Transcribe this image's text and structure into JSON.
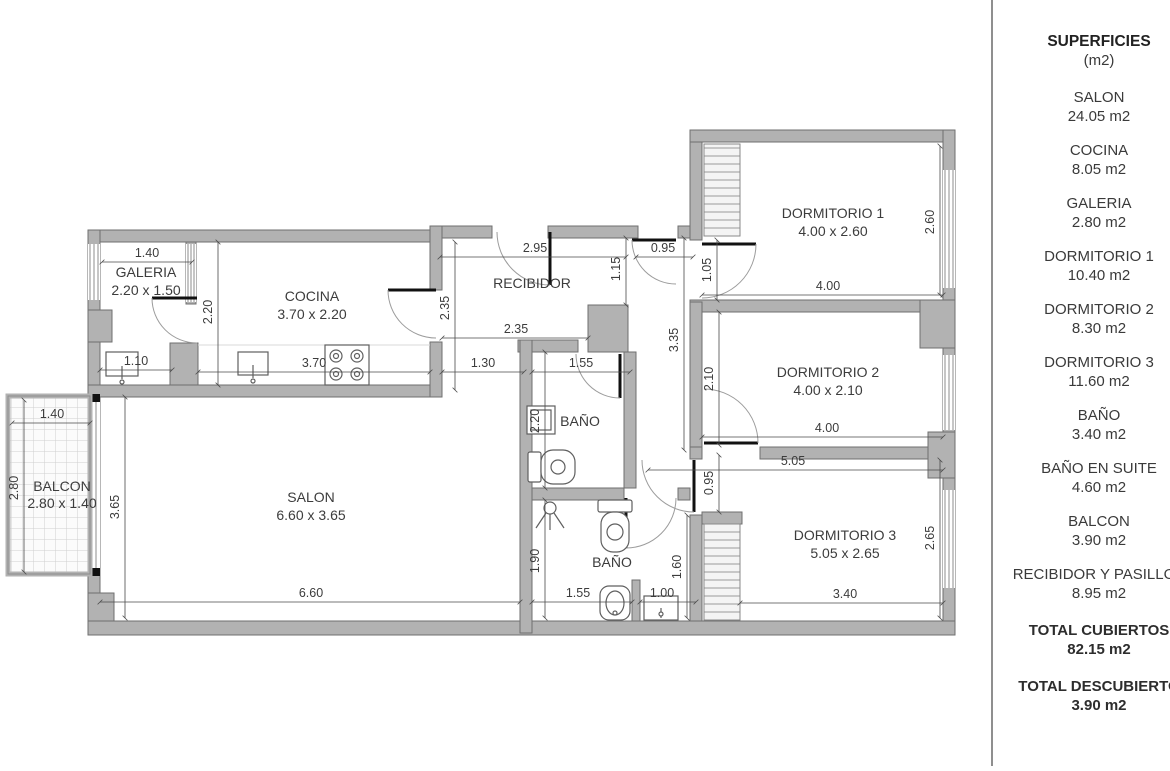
{
  "sidebar": {
    "title": "SUPERFICIES",
    "subtitle": "(m2)",
    "items": [
      {
        "label": "SALON",
        "value": "24.05 m2"
      },
      {
        "label": "COCINA",
        "value": "8.05 m2"
      },
      {
        "label": "GALERIA",
        "value": "2.80 m2"
      },
      {
        "label": "DORMITORIO 1",
        "value": "10.40 m2"
      },
      {
        "label": "DORMITORIO 2",
        "value": "8.30 m2"
      },
      {
        "label": "DORMITORIO 3",
        "value": "11.60 m2"
      },
      {
        "label": "BAÑO",
        "value": "3.40 m2"
      },
      {
        "label": "BAÑO EN SUITE",
        "value": "4.60 m2"
      },
      {
        "label": "BALCON",
        "value": "3.90 m2"
      },
      {
        "label": "RECIBIDOR Y PASILLOS",
        "value": "8.95 m2"
      }
    ],
    "totals": [
      {
        "label": "TOTAL CUBIERTOS",
        "value": "82.15 m2"
      },
      {
        "label": "TOTAL DESCUBIERTO",
        "value": "3.90 m2"
      }
    ]
  },
  "plan": {
    "rooms": [
      {
        "name": "GALERIA",
        "dims": "2.20 x 1.50"
      },
      {
        "name": "COCINA",
        "dims": "3.70 x 2.20"
      },
      {
        "name": "RECIBIDOR",
        "dims": ""
      },
      {
        "name": "DORMITORIO 1",
        "dims": "4.00 x 2.60"
      },
      {
        "name": "DORMITORIO 2",
        "dims": "4.00 x 2.10"
      },
      {
        "name": "DORMITORIO 3",
        "dims": "5.05 x 2.65"
      },
      {
        "name": "BAÑO",
        "dims": ""
      },
      {
        "name": "BAÑO",
        "dims": ""
      },
      {
        "name": "SALON",
        "dims": "6.60 x 3.65"
      },
      {
        "name": "BALCON",
        "dims": "2.80 x 1.40"
      }
    ],
    "dims_h": [
      "1.40",
      "2.95",
      "0.95",
      "2.35",
      "3.70",
      "1.30",
      "1.55",
      "1.10",
      "1.40",
      "4.00",
      "4.00",
      "5.05",
      "6.60",
      "1.55",
      "1.00",
      "3.40"
    ],
    "dims_v": [
      "2.20",
      "2.35",
      "1.15",
      "1.05",
      "3.35",
      "2.10",
      "2.60",
      "2.65",
      "2.80",
      "3.65",
      "2.20",
      "1.90",
      "1.60",
      "0.95"
    ]
  }
}
